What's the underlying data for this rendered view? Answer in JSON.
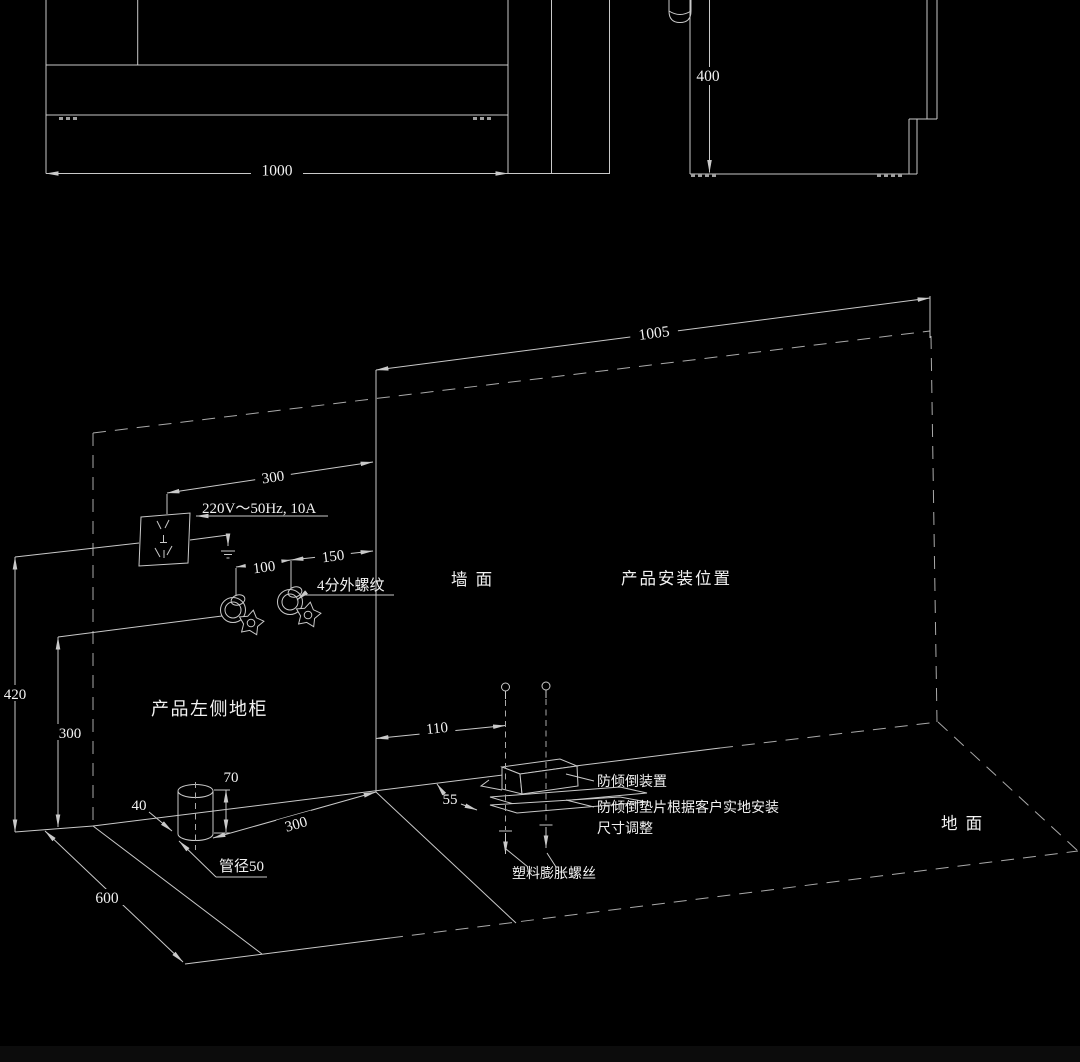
{
  "meta": {
    "background_color": "#000000",
    "line_color": "#c9c9c9",
    "dashed_line_color": "#a9a9a9",
    "text_color": "#f2f2f2"
  },
  "front_view": {
    "width_dim": "1000"
  },
  "side_view": {
    "height_dim": "400"
  },
  "wall": {
    "label": "墙  面",
    "install_label": "产品安装位置",
    "width_dim": "1005"
  },
  "left_area": {
    "cabinet_label": "产品左侧地柜",
    "socket_height_dim": "420",
    "outlet_height_dim": "300",
    "socket_offset_dim": "300",
    "power_label": "220V～50Hz, 10A",
    "outlet_spacing_dim": "100",
    "outlet_edge_dim": "150",
    "thread_label": "4分外螺纹"
  },
  "floor": {
    "label": "地  面",
    "depth_dim": "600",
    "pipe_height_dim": "70",
    "pipe_offset_dim": "40",
    "pipe_dist_dim": "300",
    "pipe_label": "管径50"
  },
  "bracket": {
    "offset_dim": "110",
    "depth_dim": "55",
    "device_label": "防倾倒装置",
    "gasket_label_1": "防倾倒垫片根据客户实地安装",
    "gasket_label_2": "尺寸调整",
    "anchor_label": "塑料膨胀螺丝"
  }
}
